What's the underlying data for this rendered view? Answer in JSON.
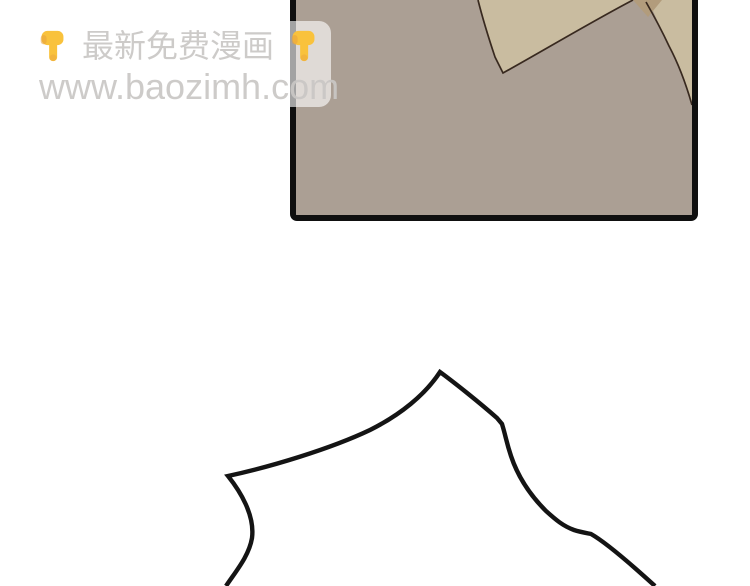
{
  "page": {
    "background": "#ffffff"
  },
  "watermark": {
    "slogan": "最新免费漫画",
    "url": "www.baozimh.com",
    "icon_left": "point-down",
    "icon_right": "point-down",
    "background": "rgba(255,255,255,0.62)",
    "text_color": "rgba(201,199,196,0.92)",
    "hand_main": "#F9C23C",
    "hand_shade": "#E8A33D"
  },
  "panel": {
    "border_color": "#0f0f0f",
    "background": "#ab9f94",
    "garment_light": "#c9bca0",
    "garment_dark": "#b29c7c",
    "outline": "#38291f"
  },
  "line_art": {
    "stroke": "#141414"
  }
}
